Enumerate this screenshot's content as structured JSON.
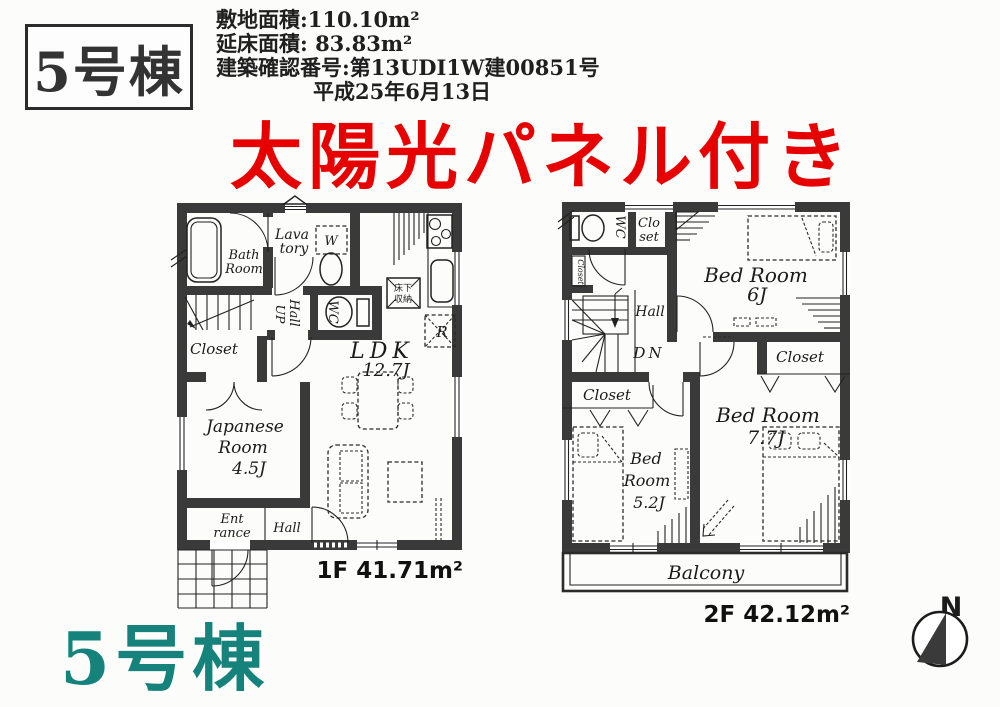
{
  "header": {
    "unit_badge": "5号棟",
    "info_lines": [
      "敷地面積:110.10m²",
      "延床面積: 83.83m²",
      "建築確認番号:第13UDI1W建00851号",
      "平成25年6月13日"
    ],
    "banner": "太陽光パネル付き"
  },
  "floor1": {
    "area_label": "1F 41.71m²",
    "labels": {
      "bath_1": "Bath",
      "bath_2": "Room",
      "lavatory_1": "Lava",
      "lavatory_2": "tory",
      "washer": "W",
      "up": "UP",
      "hall_mid": "Hall",
      "wc": "WC",
      "underfloor_1": "床下",
      "underfloor_2": "収納",
      "fridge": "R",
      "closet": "Closet",
      "ldk": "LDK",
      "ldk_size": "12.7J",
      "japanese_1": "Japanese",
      "japanese_2": "Room",
      "japanese_3": "4.5J",
      "entrance_1": "Ent",
      "entrance_2": "rance",
      "hall_bottom": "Hall"
    }
  },
  "floor2": {
    "area_label": "2F 42.12m²",
    "labels": {
      "wc": "WC",
      "closet_top_1": "Clo",
      "closet_top_2": "set",
      "closet_side": "Closet",
      "hall": "Hall",
      "down": "DN",
      "bed6_1": "Bed Room",
      "bed6_2": "6J",
      "closet_right": "Closet",
      "closet_left": "Closet",
      "bed52_1": "Bed",
      "bed52_2": "Room",
      "bed52_3": "5.2J",
      "bed77_1": "Bed Room",
      "bed77_2": "7.7J",
      "balcony": "Balcony"
    }
  },
  "footer": {
    "unit_label": "5号棟"
  },
  "compass": {
    "north": "N"
  },
  "colors": {
    "wall": "#3a3a3a",
    "accent_red": "#e60000",
    "accent_teal": "#15837c"
  }
}
